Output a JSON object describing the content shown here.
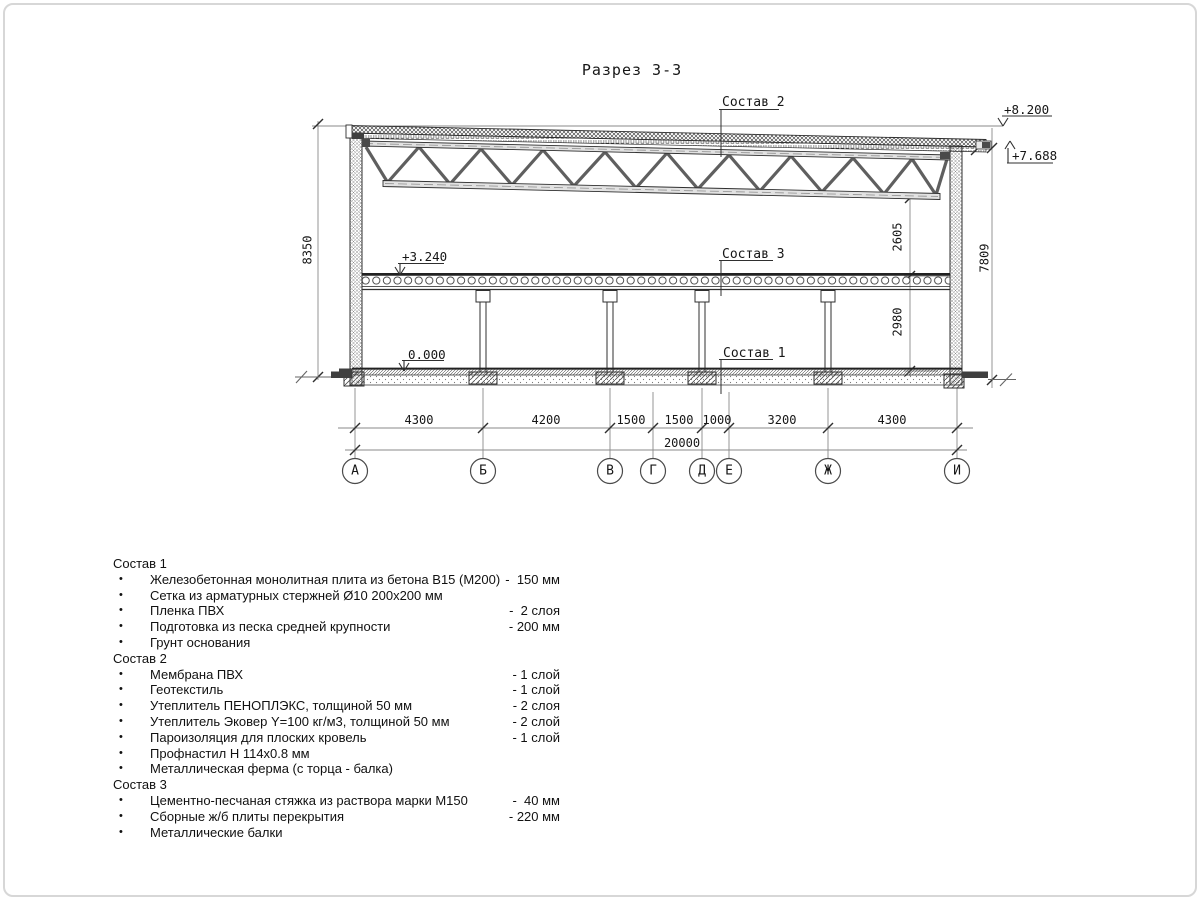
{
  "title": "Разрез 3-3",
  "bullet": "•",
  "labels": {
    "sostav1": "Состав 1",
    "sostav2": "Состав 2",
    "sostav3": "Состав 3"
  },
  "elevations": {
    "roof_high": "+8.200",
    "roof_low": "+7.688",
    "floor": "+3.240",
    "ground": "0.000"
  },
  "dims": {
    "vertical_left": "8350",
    "truss_clear": "2605",
    "floor_clear": "2980",
    "vertical_right": "7809",
    "spans": [
      "4300",
      "4200",
      "1500",
      "1500",
      "1000",
      "3200",
      "4300"
    ],
    "total": "20000"
  },
  "axes": [
    "А",
    "Б",
    "В",
    "Г",
    "Д",
    "Е",
    "Ж",
    "И"
  ],
  "legend": {
    "sections": [
      {
        "title": "Состав 1",
        "items": [
          {
            "label": "Железобетонная монолитная плита из бетона В15 (М200)",
            "value": "-  150 мм"
          },
          {
            "label": "Сетка из арматурных стержней Ø10 200х200 мм",
            "value": ""
          },
          {
            "label": "Пленка ПВХ",
            "value": "-  2 слоя"
          },
          {
            "label": "Подготовка из песка средней крупности",
            "value": "- 200 мм"
          },
          {
            "label": "Грунт основания",
            "value": ""
          }
        ]
      },
      {
        "title": "Состав 2",
        "items": [
          {
            "label": "Мембрана ПВХ",
            "value": "- 1 слой"
          },
          {
            "label": "Геотекстиль",
            "value": "- 1 слой"
          },
          {
            "label": "Утеплитель ПЕНОПЛЭКС, толщиной 50 мм",
            "value": "- 2 слоя"
          },
          {
            "label": "Утеплитель Эковер Y=100 кг/м3, толщиной 50 мм",
            "value": "- 2 слой"
          },
          {
            "label": "Пароизоляция для плоских кровель",
            "value": "- 1 слой"
          },
          {
            "label": "Профнастил Н 114х0.8 мм",
            "value": ""
          },
          {
            "label": "Металлическая ферма (с торца - балка)",
            "value": ""
          }
        ]
      },
      {
        "title": "Состав 3",
        "items": [
          {
            "label": "Цементно-песчаная стяжка из раствора марки М150",
            "value": "-  40 мм"
          },
          {
            "label": "Сборные ж/б плиты перекрытия",
            "value": "- 220 мм"
          },
          {
            "label": "Металлические балки",
            "value": ""
          }
        ]
      }
    ]
  }
}
